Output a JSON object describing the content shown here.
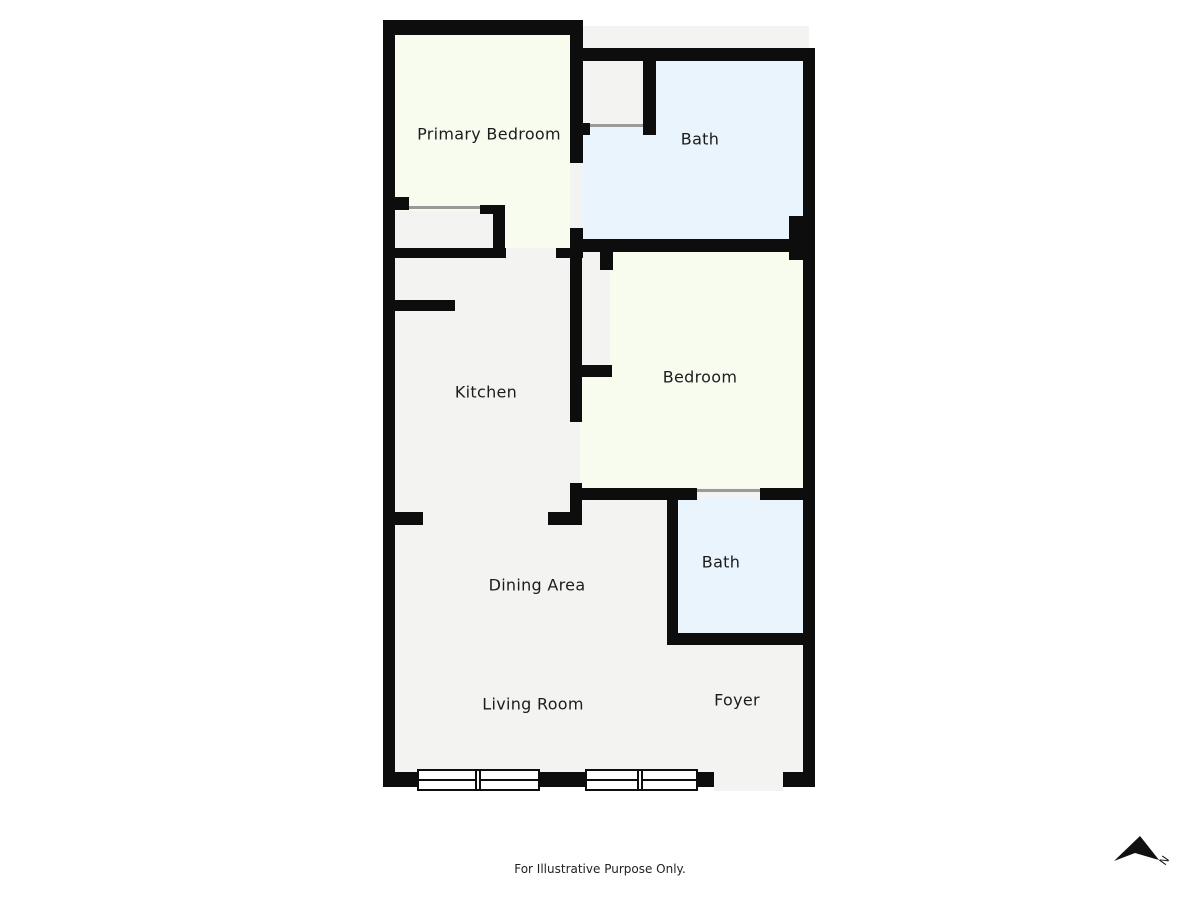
{
  "floor_plan": {
    "rooms": [
      {
        "id": "primary-bedroom",
        "label": "Primary Bedroom"
      },
      {
        "id": "bath-top",
        "label": "Bath"
      },
      {
        "id": "kitchen",
        "label": "Kitchen"
      },
      {
        "id": "bedroom",
        "label": "Bedroom"
      },
      {
        "id": "bath-lower",
        "label": "Bath"
      },
      {
        "id": "dining-area",
        "label": "Dining Area"
      },
      {
        "id": "living-room",
        "label": "Living Room"
      },
      {
        "id": "foyer",
        "label": "Foyer"
      }
    ],
    "disclaimer": "For Illustrative Purpose Only.",
    "compass": {
      "label": "N"
    },
    "colors": {
      "wall": "#0d0d0d",
      "bedroom_fill": "#f8fcef",
      "bath_fill": "#e9f4fc",
      "floor_fill": "#f3f3f1",
      "door_line": "#9a9a9a",
      "background": "#ffffff"
    }
  }
}
